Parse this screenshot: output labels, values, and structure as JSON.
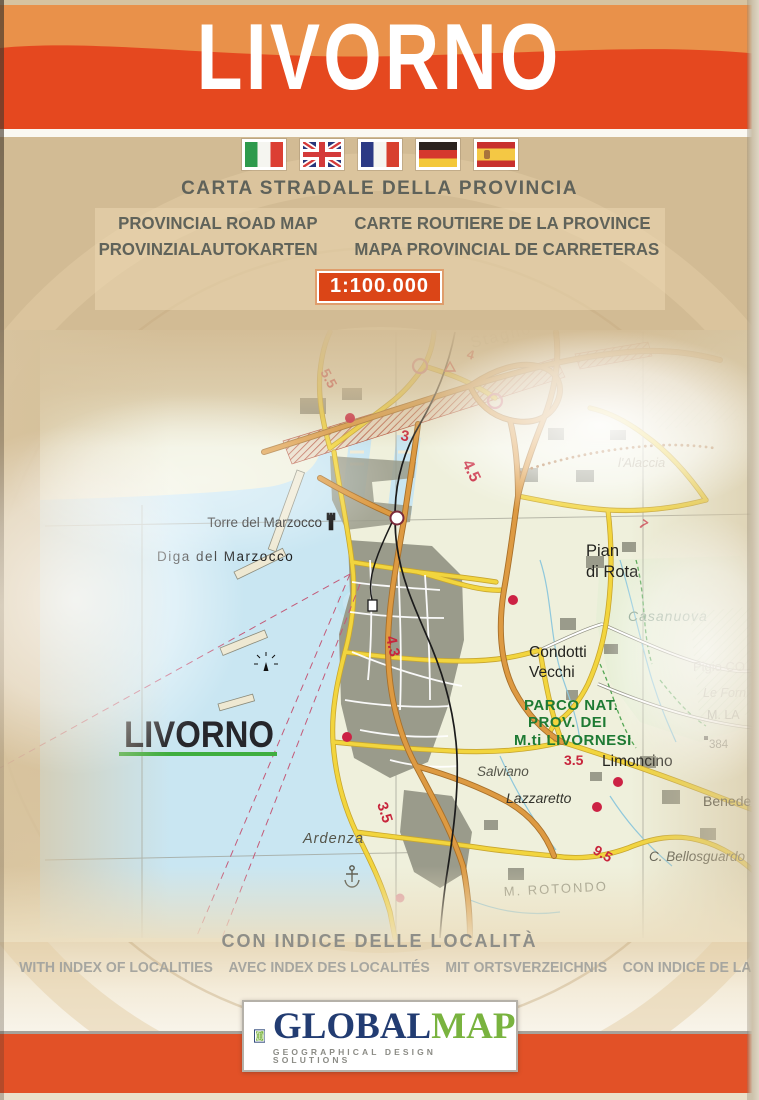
{
  "header": {
    "title": "LIVORNO"
  },
  "flags": {
    "items": [
      "italy",
      "united-kingdom",
      "france",
      "germany",
      "spain"
    ]
  },
  "titles": {
    "carta": "CARTA STRADALE DELLA PROVINCIA",
    "row1_left": "PROVINCIAL ROAD MAP",
    "row1_right": "CARTE ROUTIERE DE LA PROVINCE",
    "row2_left": "PROVINZIALAUTOKARTEN",
    "row2_right": "MAPA PROVINCIAL DE CARRETERAS",
    "scale": "1:100.000"
  },
  "map": {
    "labels": {
      "stagno": "Stagno",
      "torre": "Torre del Marzocco",
      "diga": "Diga del Marzocco",
      "city": "LIVORNO",
      "pian_1": "Pian",
      "pian_2": "di Rota",
      "condotti_1": "Condotti",
      "condotti_2": "Vecchi",
      "parco_1": "PARCO NAT.",
      "parco_2": "PROV. DEI",
      "parco_3": "M.ti LIVORNESI",
      "casanuova": "Casanuova",
      "alaccia": "l'Alaccia",
      "limoncino": "Limoncino",
      "salviano": "Salviano",
      "lazzaretto": "Lazzaretto",
      "ardenza": "Ardenza",
      "rotondo": "M. ROTONDO",
      "bellosguardo": "C. Bellosguardo",
      "pigio": "Pigio CO",
      "leforn": "Le Forn",
      "mla": "M. LA",
      "quota": "384",
      "benedetta": "Benedetta"
    },
    "road_numbers": {
      "n55": "5.5",
      "n3": "3",
      "n45": "4.5",
      "n4": "4",
      "n43": "4.3",
      "n35a": "3.5",
      "n35b": "3.5",
      "n7": "7",
      "n95": "9.5"
    }
  },
  "index_note": {
    "title": "CON INDICE DELLE LOCALITÀ",
    "langs": [
      "WITH INDEX OF LOCALITIES",
      "AVEC INDEX DES LOCALITÉS",
      "MIT ORTSVERZEICHNIS",
      "CON INDICE DE LAS LOCALIDADES"
    ]
  },
  "logo": {
    "word1": "GLOBAL",
    "word2": "MAP",
    "tagline": "GEOGRAPHICAL DESIGN SOLUTIONS"
  },
  "colors": {
    "header_orange": "#e5481f",
    "header_light_orange": "#e9914a",
    "scale_badge": "#db4517",
    "cover_tan": "#d2bb94",
    "sea": "#c9e6f2",
    "road_yellow": "#f2d53e",
    "road_orange": "#dd9a42",
    "park_green": "#1d7a33",
    "footer_orange": "#e25127",
    "logo_navy": "#223c72",
    "logo_green": "#79b33f"
  }
}
